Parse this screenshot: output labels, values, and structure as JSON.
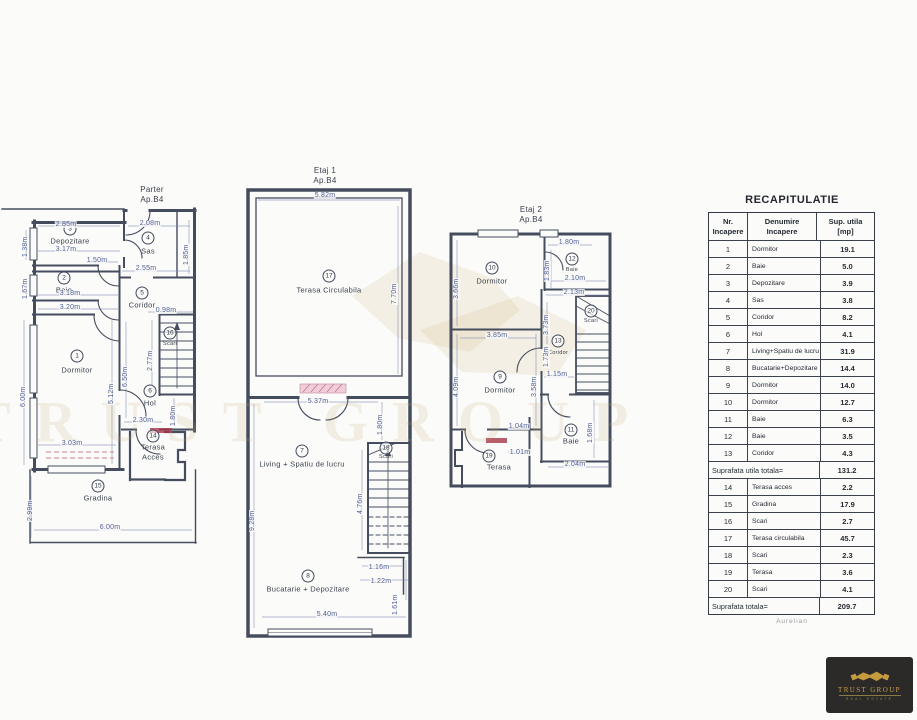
{
  "colors": {
    "line": "#454c5d",
    "dim_text": "#4e5d94",
    "accent_red": "#a83648",
    "hatch_pink": "#d898ab",
    "watermark_gold": "#c1ac70",
    "logo_gold": "#c49a3f",
    "logo_bg": "#2b2a28"
  },
  "watermark": {
    "text": "TRUST GROUP"
  },
  "logo": {
    "title": "TRUST GROUP",
    "subtitle": "REAL ESTATE"
  },
  "footer_note": "Aurelian",
  "plans": {
    "parter": {
      "title": [
        "Parter",
        "Ap.B4"
      ],
      "rooms": [
        {
          "num": "3",
          "name": "Depozitare"
        },
        {
          "num": "4",
          "name": "Sas"
        },
        {
          "num": "2",
          "name": "Baie"
        },
        {
          "num": "5",
          "name": "Coridor"
        },
        {
          "num": "16",
          "name": "Scari"
        },
        {
          "num": "1",
          "name": "Dormitor"
        },
        {
          "num": "6",
          "name": "Hol"
        },
        {
          "num": "14",
          "name": "Terasa",
          "name2": "Acces"
        },
        {
          "num": "15",
          "name": "Gradina"
        }
      ],
      "dims": [
        "2.85m",
        "3.17m",
        "1.38m",
        "2.08m",
        "1.85m",
        "1.50m",
        "1.67m",
        "3.18m",
        "2.55m",
        "3.20m",
        "0.98m",
        "2.77m",
        "6.00m",
        "5.12m",
        "6.50m",
        "1.80m",
        "2.30m",
        "3.03m",
        "2.99m",
        "6.00m"
      ]
    },
    "etaj1": {
      "title": [
        "Etaj 1",
        "Ap.B4"
      ],
      "rooms": [
        {
          "num": "17",
          "name": "Terasa Circulabila"
        },
        {
          "num": "7",
          "name": "Living + Spatiu de lucru"
        },
        {
          "num": "18",
          "name": "Scari"
        },
        {
          "num": "8",
          "name": "Bucatarie + Depozitare"
        }
      ],
      "dims": [
        "5.82m",
        "7.70m",
        "5.37m",
        "1.80m",
        "9.28m",
        "4.76m",
        "1.16m",
        "1.22m",
        "1.61m",
        "5.40m"
      ]
    },
    "etaj2": {
      "title": [
        "Etaj 2",
        "Ap.B4"
      ],
      "rooms": [
        {
          "num": "10",
          "name": "Dormitor"
        },
        {
          "num": "12",
          "name": "Baie"
        },
        {
          "num": "20",
          "name": "Scari"
        },
        {
          "num": "13",
          "name": "Coridor"
        },
        {
          "num": "9",
          "name": "Dormitor"
        },
        {
          "num": "19",
          "name": "Terasa"
        },
        {
          "num": "11",
          "name": "Baie"
        }
      ],
      "dims": [
        "1.80m",
        "1.83m",
        "2.10m",
        "2.13m",
        "3.66m",
        "3.85m",
        "4.09m",
        "3.58m",
        "3.73m",
        "1.73m",
        "1.15m",
        "1.04m",
        "1.01m",
        "1.68m",
        "2.04m"
      ]
    }
  },
  "table": {
    "title": "RECAPITULATIE",
    "header": {
      "c1a": "Nr.",
      "c1b": "Incapere",
      "c2a": "Denumire",
      "c2b": "Incapere",
      "c3a": "Sup. utila",
      "c3b": "[mp]"
    },
    "rows": [
      {
        "nr": "1",
        "name": "Dormitor",
        "mp": "19.1"
      },
      {
        "nr": "2",
        "name": "Baie",
        "mp": "5.0"
      },
      {
        "nr": "3",
        "name": "Depozitare",
        "mp": "3.9"
      },
      {
        "nr": "4",
        "name": "Sas",
        "mp": "3.8"
      },
      {
        "nr": "5",
        "name": "Coridor",
        "mp": "8.2"
      },
      {
        "nr": "6",
        "name": "Hol",
        "mp": "4.1"
      },
      {
        "nr": "7",
        "name": "Living+Spatiu de lucru",
        "mp": "31.9"
      },
      {
        "nr": "8",
        "name": "Bucatarie+Depozitare",
        "mp": "14.4"
      },
      {
        "nr": "9",
        "name": "Dormitor",
        "mp": "14.0"
      },
      {
        "nr": "10",
        "name": "Dormitor",
        "mp": "12.7"
      },
      {
        "nr": "11",
        "name": "Baie",
        "mp": "6.3"
      },
      {
        "nr": "12",
        "name": "Baie",
        "mp": "3.5"
      },
      {
        "nr": "13",
        "name": "Coridor",
        "mp": "4.3"
      }
    ],
    "subtotal_label": "Suprafata utila totala=",
    "subtotal_value": "131.2",
    "rows2": [
      {
        "nr": "14",
        "name": "Terasa acces",
        "mp": "2.2"
      },
      {
        "nr": "15",
        "name": "Gradina",
        "mp": "17.9"
      },
      {
        "nr": "16",
        "name": "Scari",
        "mp": "2.7"
      },
      {
        "nr": "17",
        "name": "Terasa circulabila",
        "mp": "45.7"
      },
      {
        "nr": "18",
        "name": "Scari",
        "mp": "2.3"
      },
      {
        "nr": "19",
        "name": "Terasa",
        "mp": "3.6"
      },
      {
        "nr": "20",
        "name": "Scari",
        "mp": "4.1"
      }
    ],
    "total_label": "Suprafata totala=",
    "total_value": "209.7"
  }
}
